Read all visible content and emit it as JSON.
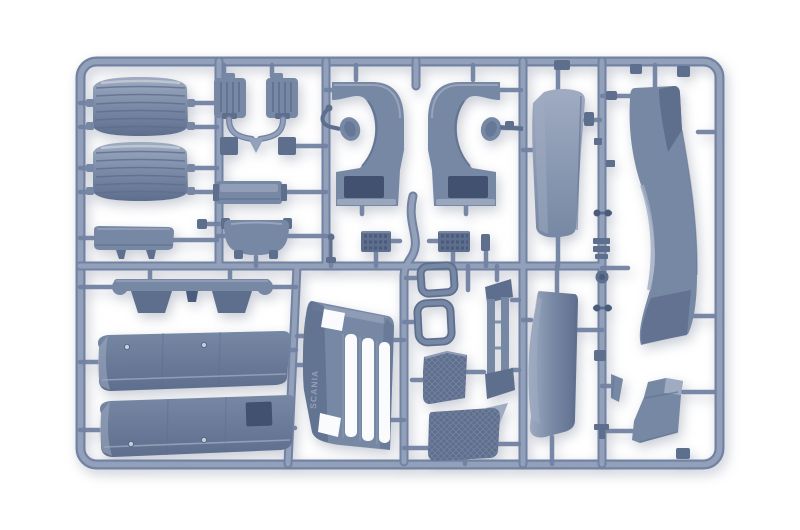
{
  "photo": {
    "alt": "Plastic model kit sprue moulded in blue-grey styrene containing truck cab body parts on a white background",
    "grille_molded_text": "SCANIA"
  },
  "colors": {
    "background": "#ffffff",
    "runner": "#93a0ba",
    "runner_shade": "#7282a2",
    "part": "#7788a4",
    "part_light": "#9fabc1",
    "part_lighter": "#c6cdda",
    "part_dark": "#5e6e8d",
    "part_darker": "#4a5b7c",
    "hole": "#42516f",
    "slot": "#f9fbfd",
    "texture": "#8895ae",
    "molded_text": "#96a3ba"
  },
  "parts": {
    "roof_panels": "ribbed roof hatch panels",
    "sun_visor": "sun visor strip",
    "vent_brackets": "ribbed vent brackets",
    "small_plates": "small square plates",
    "bunk_shelf": "ribbed shelf plate",
    "engine_tunnel": "engine tunnel cover",
    "wheel_arches": "cab wheel arch liners",
    "mirror_arms": "mirror arms",
    "radiator_cores": "studded radiator cores",
    "antenna": "antenna mast",
    "side_blade": "cab side trim blade",
    "roof_deflector": "roof air deflector panel",
    "hinge_strip": "hinged mudflap strip",
    "side_skirts": "chassis side skirt panels",
    "front_grille": "front grille panel",
    "window_frames": "window frames",
    "tread_plates": "chequered tread plates",
    "door_channel": "door frame channel",
    "side_deflector": "cab side air deflector",
    "wind_wedge": "wind deflector wedge",
    "step_panel": "entry step panel",
    "fittings": "small fittings and clips"
  }
}
